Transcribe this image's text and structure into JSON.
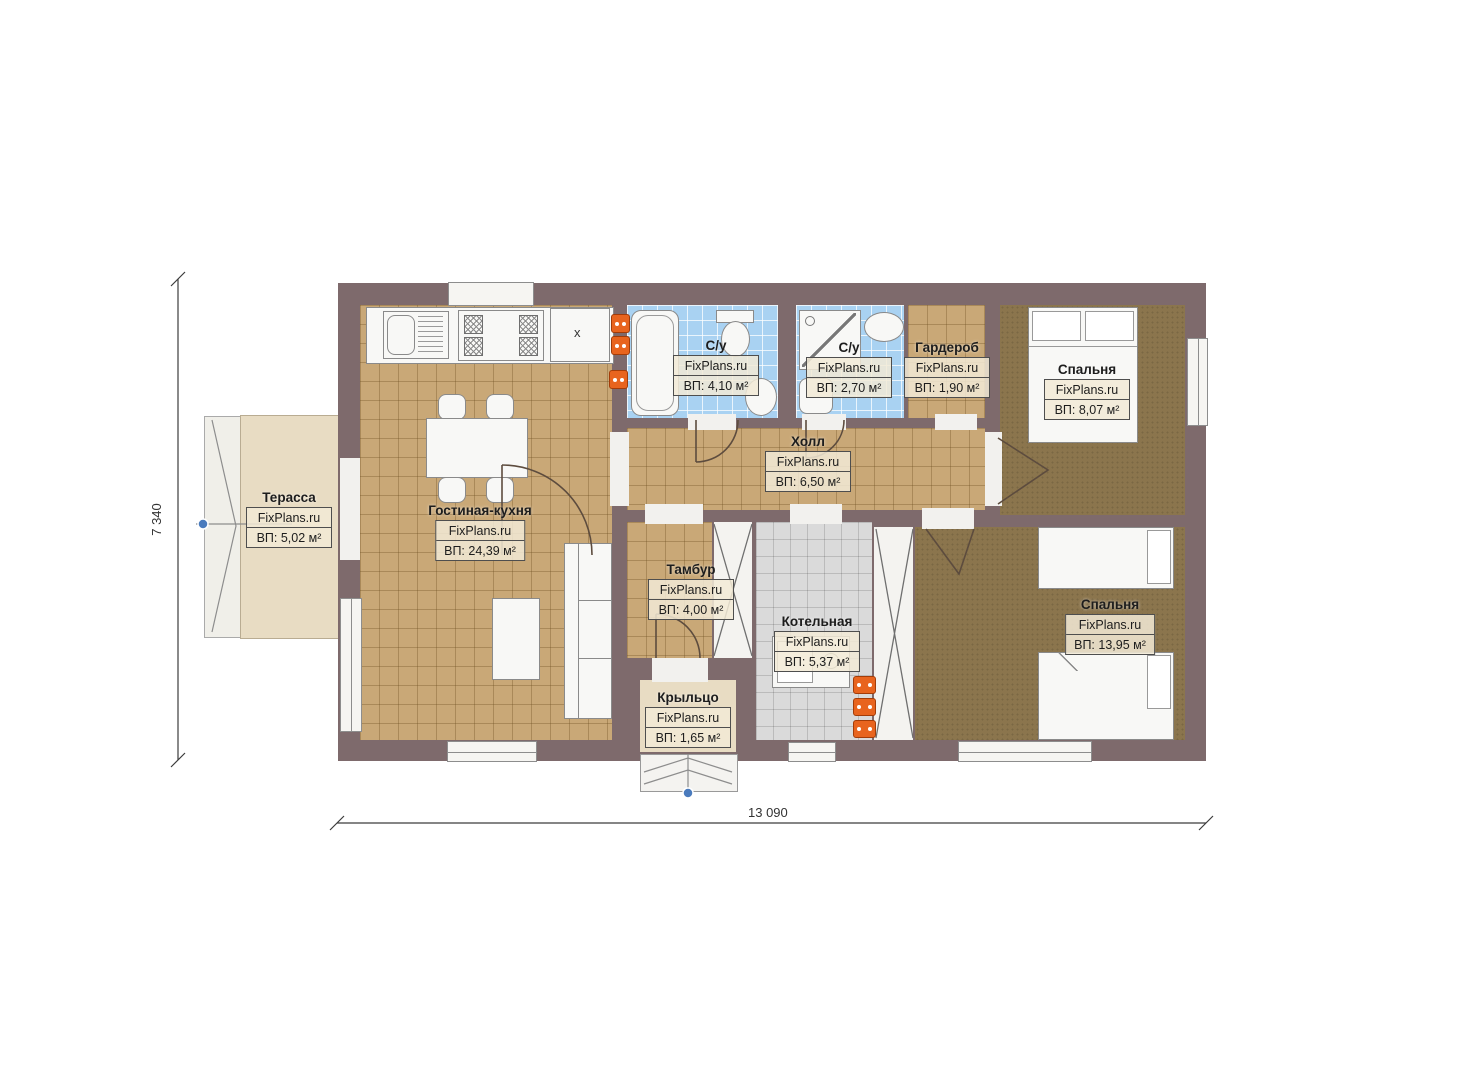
{
  "brand": "FixPlans.ru",
  "dimensions": {
    "height_label": "7 340",
    "width_label": "13 090"
  },
  "rooms": [
    {
      "name": "Терасса",
      "area": "ВП: 5,02 м²"
    },
    {
      "name": "Гостиная-кухня",
      "area": "ВП: 24,39 м²"
    },
    {
      "name": "С/у",
      "area": "ВП: 4,10 м²"
    },
    {
      "name": "С/у",
      "area": "ВП: 2,70 м²"
    },
    {
      "name": "Гардероб",
      "area": "ВП: 1,90 м²"
    },
    {
      "name": "Спальня",
      "area": "ВП: 8,07 м²"
    },
    {
      "name": "Холл",
      "area": "ВП: 6,50 м²"
    },
    {
      "name": "Тамбур",
      "area": "ВП: 4,00 м²"
    },
    {
      "name": "Котельная",
      "area": "ВП: 5,37 м²"
    },
    {
      "name": "Спальня",
      "area": "ВП: 13,95 м²"
    },
    {
      "name": "Крыльцо",
      "area": "ВП: 1,65 м²"
    }
  ],
  "kitchen": {
    "cabinet_mark": "x"
  },
  "colors": {
    "wall": "#7e6a6c",
    "floor_tan": "#c9a877",
    "floor_blue": "#a9d2f2",
    "floor_gray": "#dadada",
    "carpet": "#8b754d",
    "terrace": "#e8dcc3",
    "radiator": "#e8641e",
    "marker_blue": "#4a7bbd"
  }
}
